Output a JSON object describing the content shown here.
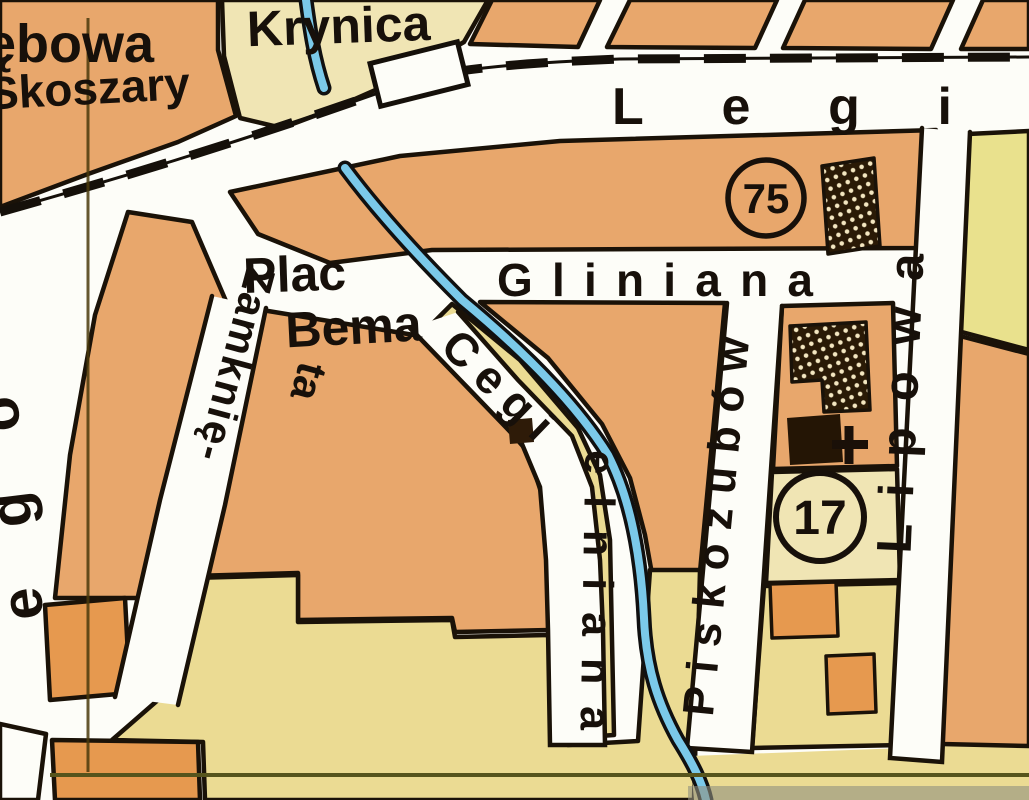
{
  "map": {
    "kind": "scanned city street map (Polish town plan)",
    "labels": {
      "debowa_partial": "ębowa",
      "krynica": "Krynica",
      "skoszary": "Skoszary",
      "legionow_partial": "Legi",
      "plac_bema_line1": "Plac",
      "plac_bema_line2": "Bema",
      "gliniana": "Gliniana",
      "zamknieta_line1": "Zamknię-",
      "zamknieta_line2": "ta",
      "cegielniana_part1": "Cegi",
      "cegielniana_part2": "elniana",
      "piskozubow": "Piskozubów",
      "lipowa": "Lipowa",
      "ego_partial": "ego"
    },
    "badges": {
      "route_75": "75",
      "route_17": "17"
    },
    "features": {
      "railway": "railway-line-with-station",
      "stream": "blue-stream",
      "church": "black-building-with-cross",
      "hatched_buildings": "cross-hatched-public-buildings",
      "boundary_lines": "thin-olive-district-boundary"
    },
    "colors": {
      "block_salmon": "#e8a76c",
      "block_yellow": "#ebdb93",
      "block_yellow_pale": "#f0e5b4",
      "block_yellow_green": "#e9e18d",
      "building_orange": "#e6994f",
      "building_dark": "#2a1a06",
      "stream_blue": "#7bc9e9",
      "road_white": "#fdfdf8",
      "ink": "#17100a",
      "boundary_olive": "#56541c"
    }
  }
}
